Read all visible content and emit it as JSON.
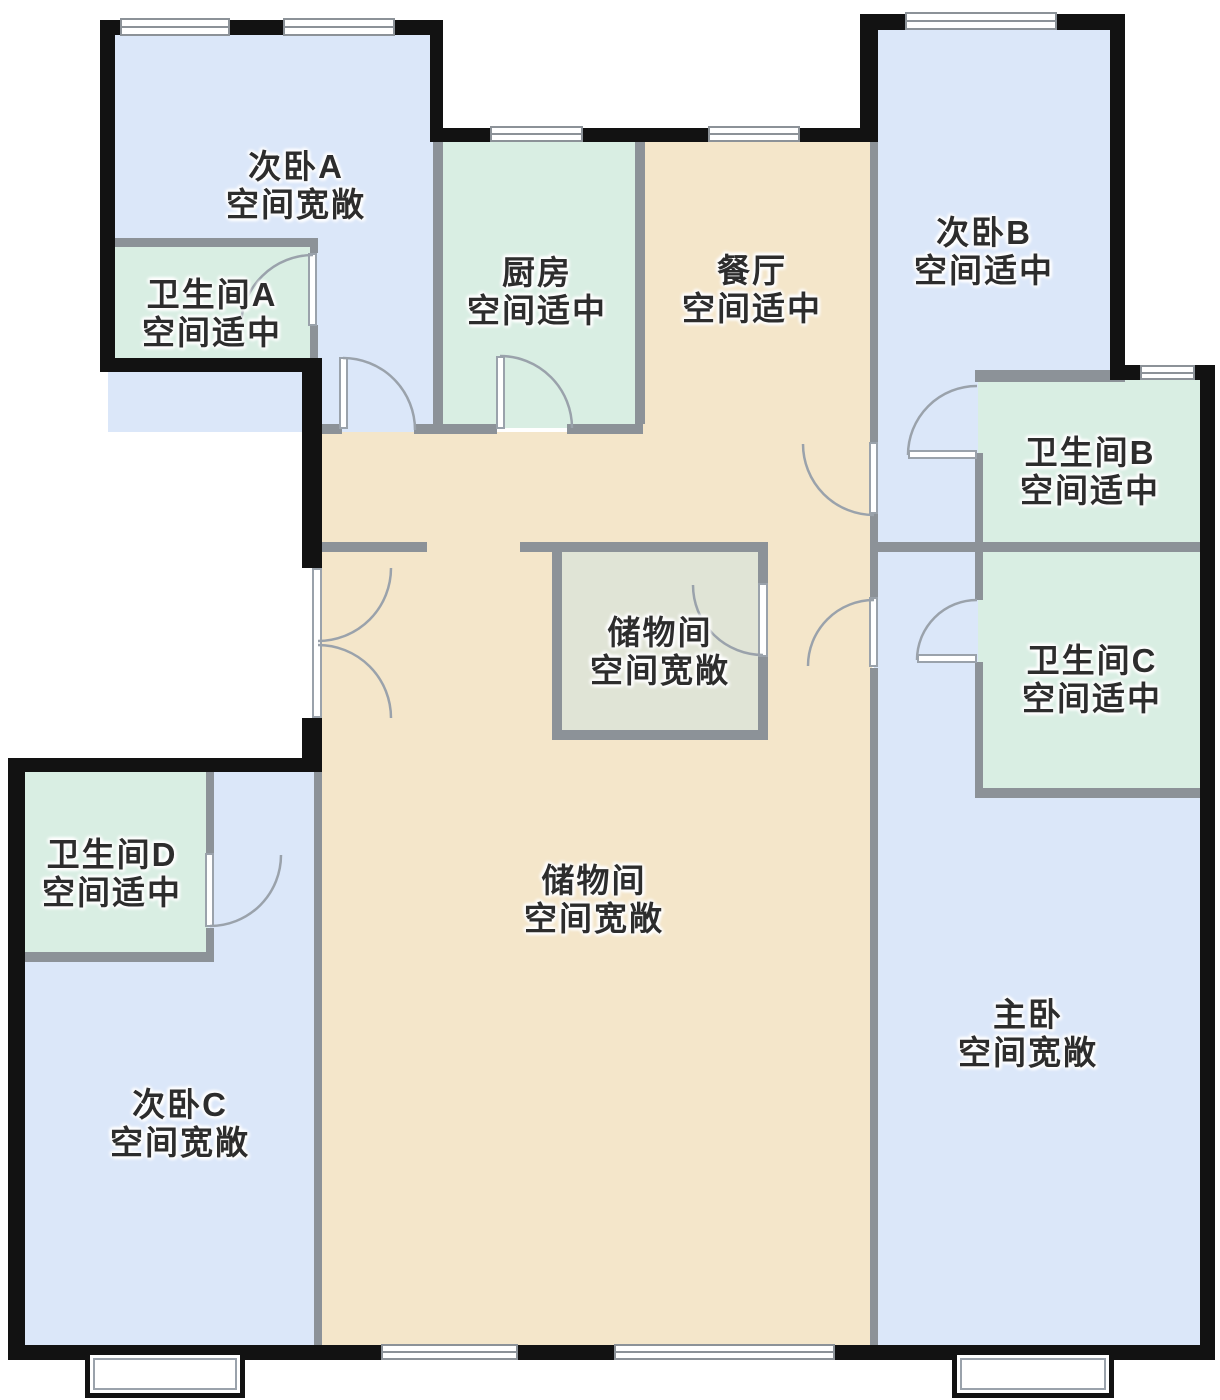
{
  "palette": {
    "bedroom_fill": "#dbe7f9",
    "wet_fill": "#d9eee3",
    "hall_fill": "#f4e6ca",
    "storage_fill": "#e0e4d6",
    "wall": "#121212",
    "partition": "#8c9298",
    "door_line": "#9aa2ab",
    "label_text": "#2d2d2d"
  },
  "rooms": [
    {
      "id": "bedroom-a",
      "name": "次卧A",
      "desc": "空间宽敞"
    },
    {
      "id": "bathroom-a",
      "name": "卫生间A",
      "desc": "空间适中"
    },
    {
      "id": "kitchen",
      "name": "厨房",
      "desc": "空间适中"
    },
    {
      "id": "dining",
      "name": "餐厅",
      "desc": "空间适中"
    },
    {
      "id": "bedroom-b",
      "name": "次卧B",
      "desc": "空间适中"
    },
    {
      "id": "bathroom-b",
      "name": "卫生间B",
      "desc": "空间适中"
    },
    {
      "id": "storage-small",
      "name": "储物间",
      "desc": "空间宽敞"
    },
    {
      "id": "bathroom-c",
      "name": "卫生间C",
      "desc": "空间适中"
    },
    {
      "id": "bathroom-d",
      "name": "卫生间D",
      "desc": "空间适中"
    },
    {
      "id": "storage-hall",
      "name": "储物间",
      "desc": "空间宽敞"
    },
    {
      "id": "bedroom-c",
      "name": "次卧C",
      "desc": "空间宽敞"
    },
    {
      "id": "master-bedroom",
      "name": "主卧",
      "desc": "空间宽敞"
    }
  ]
}
